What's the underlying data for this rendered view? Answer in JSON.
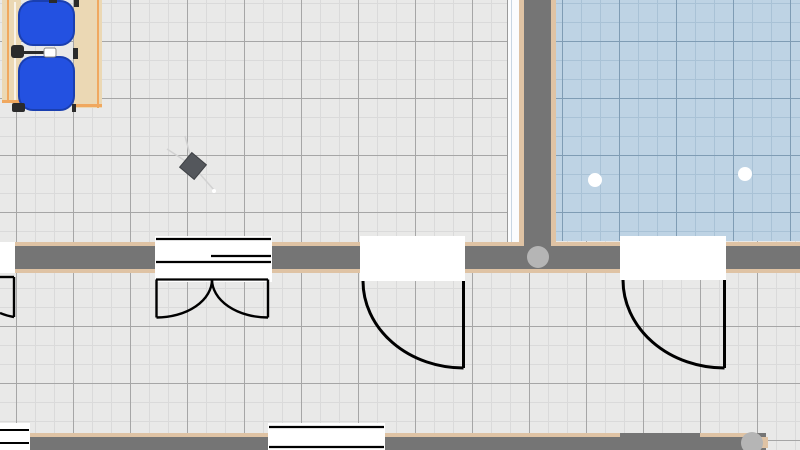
{
  "canvas": {
    "width": 800,
    "height": 450,
    "view": "floor-plan-2d"
  },
  "colors": {
    "wall": "#757575",
    "wall_edge": "#dfc3a4",
    "floor_gray": "#e9e9e8",
    "floor_gray_grid_major": "#a6a6a6",
    "floor_gray_grid_minor": "#dadada",
    "floor_blue": "#bed3e4",
    "floor_blue_grid_major": "#7f9cb4",
    "floor_blue_grid_minor": "#a9c2d6",
    "door_fill": "#ffffff",
    "door_line": "#000000",
    "junction": "#b5b5b5",
    "chair": "#2351e1",
    "chair_outline": "#1a3fb0",
    "desk": "#ebd8b4",
    "desk_edge": "#f0a85f",
    "marker": "#2b2b2b",
    "handle_fill": "#ffffff",
    "handle_stroke": "#8a8a8a",
    "diamond": "#54575c",
    "diamond_outline": "#3e4145",
    "ray": "#d2d2d2",
    "light": "#ffffff"
  },
  "rooms": [
    {
      "id": "main-room",
      "floor": "gray-tiles"
    },
    {
      "id": "tiled-room",
      "floor": "blue-tiles"
    }
  ],
  "walls": [
    {
      "id": "wall-horizontal-mid"
    },
    {
      "id": "wall-vertical"
    },
    {
      "id": "wall-bottom"
    }
  ],
  "openings": [
    {
      "id": "door-edge-left",
      "type": "single-door"
    },
    {
      "id": "door-double",
      "type": "double-door"
    },
    {
      "id": "door-single-1",
      "type": "single-door"
    },
    {
      "id": "door-single-2",
      "type": "single-door"
    },
    {
      "id": "window-1",
      "type": "window"
    },
    {
      "id": "window-2",
      "type": "window"
    }
  ],
  "furniture": [
    {
      "id": "desk-left",
      "type": "desk"
    },
    {
      "id": "desk-right",
      "type": "desk"
    },
    {
      "id": "chair-1",
      "type": "office-chair"
    },
    {
      "id": "chair-2",
      "type": "office-chair"
    },
    {
      "id": "rotated-object",
      "type": "small-table"
    },
    {
      "id": "ceiling-light-1",
      "type": "light"
    },
    {
      "id": "ceiling-light-2",
      "type": "light"
    }
  ]
}
